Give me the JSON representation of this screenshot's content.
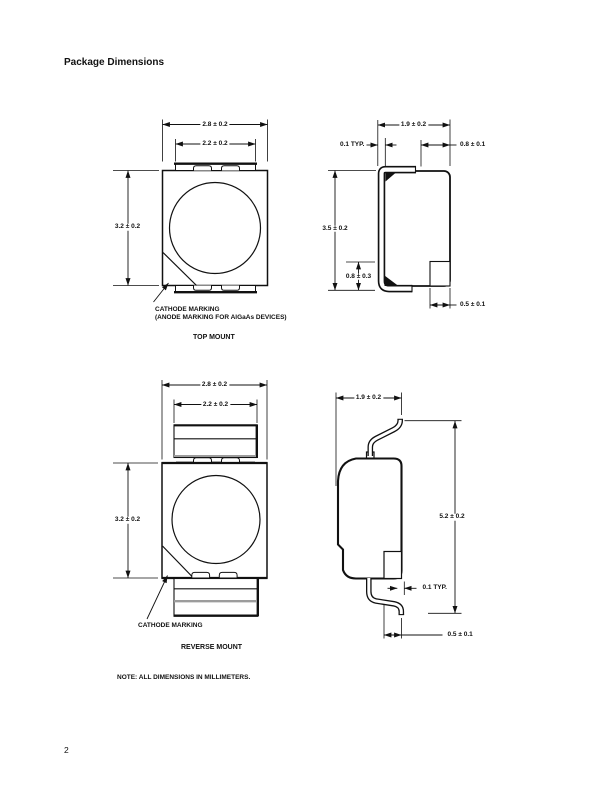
{
  "page": {
    "title": "Package Dimensions",
    "note": "NOTE: ALL DIMENSIONS IN MILLIMETERS.",
    "page_number": "2"
  },
  "top_mount": {
    "caption": "TOP MOUNT",
    "callout_line1": "CATHODE MARKING",
    "callout_line2": "(ANODE MARKING FOR AlGaAs DEVICES)",
    "front_view": {
      "dim_width_outer": "2.8 ± 0.2",
      "dim_width_inner": "2.2 ± 0.2",
      "dim_height": "3.2 ± 0.2"
    },
    "side_view": {
      "dim_width": "1.9 ± 0.2",
      "dim_lead_thickness": "0.1 TYP.",
      "dim_pad_top": "0.8 ± 0.1",
      "dim_height": "3.5 ± 0.2",
      "dim_lead_bend": "0.8 ± 0.3",
      "dim_pad_bottom": "0.5 ± 0.1"
    }
  },
  "reverse_mount": {
    "caption": "REVERSE MOUNT",
    "callout_line1": "CATHODE MARKING",
    "front_view": {
      "dim_width_outer": "2.8 ± 0.2",
      "dim_width_inner": "2.2 ± 0.2",
      "dim_height": "3.2 ± 0.2"
    },
    "side_view": {
      "dim_width": "1.9 ± 0.2",
      "dim_height": "5.2 ± 0.2",
      "dim_lead_thickness": "0.1 TYP.",
      "dim_pad_bottom": "0.5 ± 0.1"
    }
  },
  "colors": {
    "ink": "#111111",
    "gray_line": "#9c9c9c",
    "paper": "#ffffff"
  }
}
